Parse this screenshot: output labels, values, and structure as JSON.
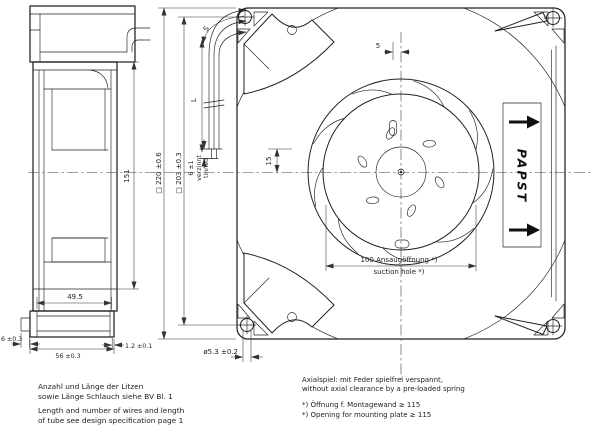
{
  "drawing": {
    "side_view": {
      "dim_height": "151",
      "dim_depth_inner": "49.5",
      "dim_depth": "56 ±0.3",
      "dim_tab": "6 ±0.3",
      "dim_lip": "1.2 ±0.1"
    },
    "leads": {
      "dim_length": "L",
      "dim_tube": "S",
      "dim_strip": "6 ±1",
      "strip_de": "verzinnt",
      "strip_en": "tinned"
    },
    "front_view": {
      "dim_outer": "□ 220 ±0.6",
      "dim_holes": "□ 203 ±0.3",
      "dim_offset": "5",
      "dim_center": "15",
      "dim_hole": "ø5.3 ±0.2",
      "suction_de": "100 Ansaugöffnung *)",
      "suction_en": "suction hole *)",
      "brand": "PAPST"
    },
    "notes": {
      "wires_de_1": "Anzahl und Länge der Litzen",
      "wires_de_2": "sowie Länge Schlauch siehe BV Bl. 1",
      "wires_en_1": "Length and number of wires and length",
      "wires_en_2": "of tube see design specification page 1",
      "axial_de": "Axialspiel: mit Feder spielfrei verspannt,",
      "axial_en": "without axial clearance by a pre-loaded spring",
      "opening_de": "*) Öffnung f. Montagewand ≥ 115",
      "opening_en": "*) Opening for mounting plate ≥ 115"
    }
  }
}
